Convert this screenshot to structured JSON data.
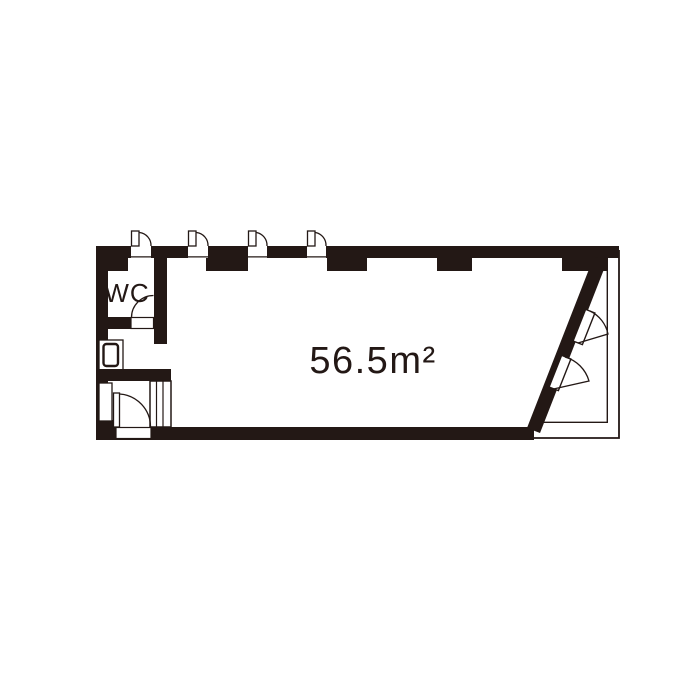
{
  "floor_plan": {
    "wc_label": "WC",
    "area_label": "56.5m²",
    "colors": {
      "wall": "#231815",
      "background": "#ffffff"
    },
    "features": {
      "top_windows": 4,
      "doors": [
        "wc-door",
        "entrance-door",
        "balcony-double-door"
      ],
      "fixtures": [
        "washbasin",
        "shoe-cabinet"
      ]
    }
  }
}
